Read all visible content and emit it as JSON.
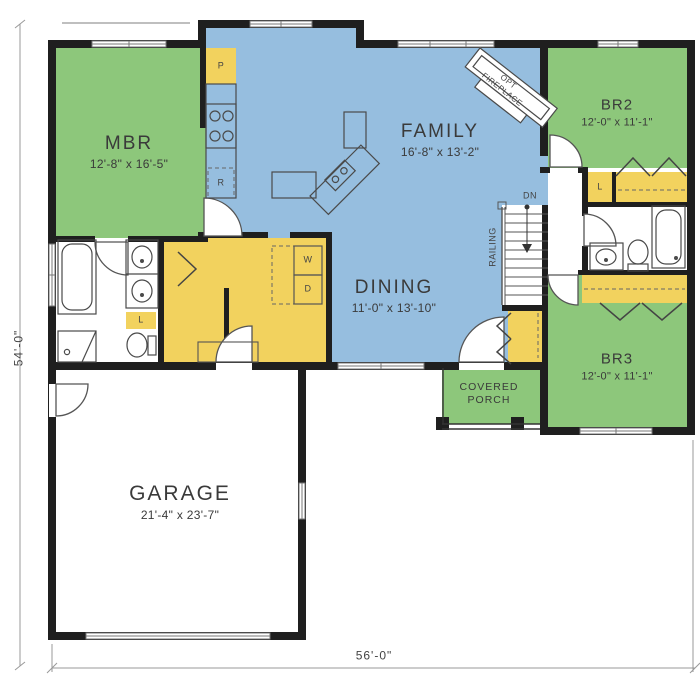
{
  "plan": {
    "overall": {
      "width_label": "56'-0\"",
      "height_label": "54'-0\""
    },
    "rooms": {
      "mbr": {
        "name": "MBR",
        "size": "12'-8\" x 16'-5\""
      },
      "family": {
        "name": "FAMILY",
        "size": "16'-8\" x 13'-2\""
      },
      "br2": {
        "name": "BR2",
        "size": "12'-0\" x 11'-1\""
      },
      "dining": {
        "name": "DINING",
        "size": "11'-0\" x 13'-10\""
      },
      "br3": {
        "name": "BR3",
        "size": "12'-0\" x 11'-1\""
      },
      "garage": {
        "name": "GARAGE",
        "size": "21'-4\" x 23'-7\""
      },
      "porch": {
        "name": "COVERED PORCH"
      }
    },
    "annotations": {
      "fireplace": "OPT FIREPLACE",
      "stairs_down": "DN",
      "railing": "RAILING",
      "pantry": "P",
      "refrigerator": "R",
      "washer": "W",
      "dryer": "D",
      "linen": "L"
    },
    "colors": {
      "bedroom_green": "#8dc77b",
      "living_blue": "#96bedf",
      "closet_yellow": "#f2d25e",
      "wall_black": "#1f1f1f"
    }
  }
}
